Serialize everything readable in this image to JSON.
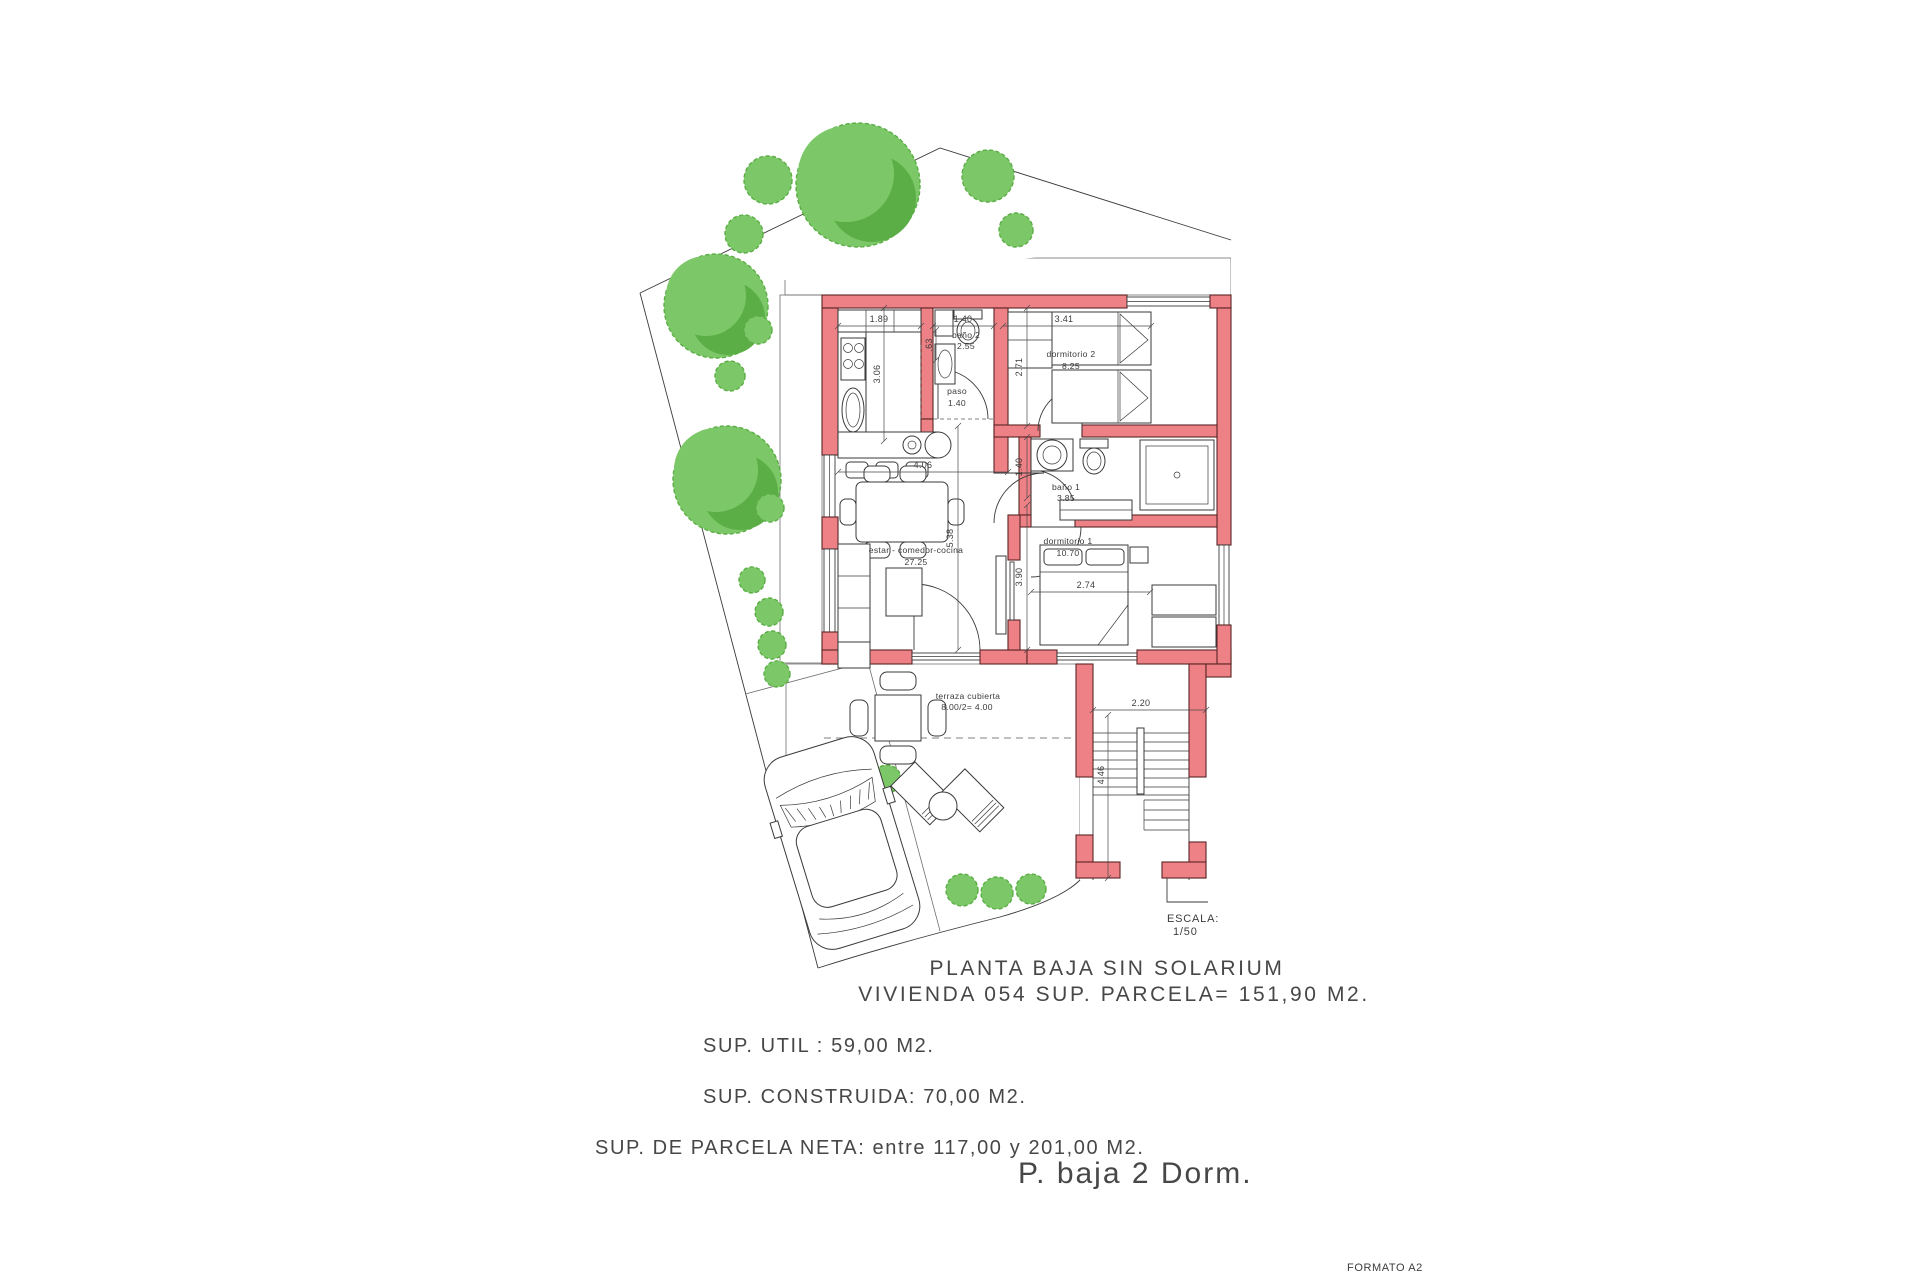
{
  "drawing": {
    "title_line1": "PLANTA BAJA SIN SOLARIUM",
    "title_line2": "VIVIENDA 054 SUP. PARCELA= 151,90 M2.",
    "sup_util": "SUP. UTIL : 59,00 M2.",
    "sup_construida": "SUP. CONSTRUIDA: 70,00 M2.",
    "sup_parcela": "SUP. DE PARCELA NETA: entre 117,00 y 201,00 M2.",
    "footer_label": "P. baja 2 Dorm.",
    "formato": "FORMATO A2",
    "escala_label": "ESCALA:",
    "escala_value": "1/50"
  },
  "rooms": {
    "estar": {
      "label": "estar - comedor-cocina",
      "area": "27.25"
    },
    "dorm1": {
      "label": "dormitorio 1",
      "area": "10.70"
    },
    "dorm2": {
      "label": "dormitorio 2",
      "area": "8.25"
    },
    "bano1": {
      "label": "baño 1",
      "area": "3.85"
    },
    "bano2": {
      "label": "baño 2",
      "area": "2.55"
    },
    "paso": {
      "label": "paso",
      "area": "1.40"
    },
    "terraza": {
      "label": "terraza cubierta",
      "area": "8.00/2= 4.00"
    }
  },
  "dims": {
    "kitchen_w": "1.89",
    "kitchen_h": "3.06",
    "bano2_w": "1.40",
    "bano2_d": ".63",
    "dorm2_w": "3.41",
    "dorm2_h": "2.71",
    "estar_w": "4.06",
    "estar_h": "5.38",
    "bano1_h": "1.40",
    "dorm1_h": "3.90",
    "dorm1_w": "2.74",
    "stairs_w": "2.20",
    "stairs_h": "4.46"
  },
  "colors": {
    "wall_fill": "#ED8186",
    "wall_stroke": "#5a2424",
    "tree_light": "#7CC868",
    "tree_dark": "#5BAD45",
    "line": "#3a3a3a",
    "grid": "#8f8f8f",
    "text": "#3c3c3c"
  }
}
